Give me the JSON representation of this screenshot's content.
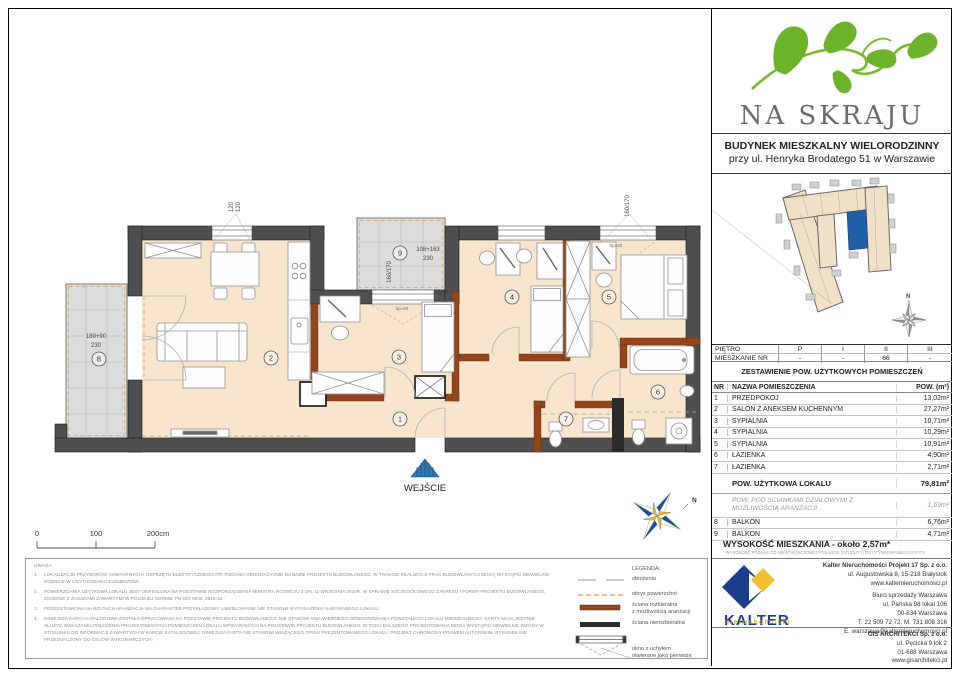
{
  "brand": {
    "title": "NA SKRAJU"
  },
  "building_info": {
    "line1": "BUDYNEK MIESZKALNY WIELORODZINNY",
    "line2": "przy ul. Henryka Brodatego 51 w Warszawie"
  },
  "floor_table": {
    "floor_label": "PIĘTRO",
    "floors": [
      "P",
      "I",
      "II",
      "III"
    ],
    "apt_label": "MIESZKANIE NR",
    "apt_values": [
      "-",
      "-",
      "66",
      "-"
    ]
  },
  "area_table": {
    "title": "ZESTAWIENIE POW. UŻYTKOWYCH POMIESZCZEŃ",
    "col_nr": "NR",
    "col_name": "NAZWA POMIESZCZENIA",
    "col_area": "POW. (m²)",
    "rows": [
      {
        "nr": "1",
        "name": "PRZEDPOKÓJ",
        "area": "13,02m²"
      },
      {
        "nr": "2",
        "name": "SALON Z ANEKSEM KUCHENNYM",
        "area": "27,27m²"
      },
      {
        "nr": "3",
        "name": "SYPIALNIA",
        "area": "10,71m²"
      },
      {
        "nr": "4",
        "name": "SYPIALNIA",
        "area": "10,29m²"
      },
      {
        "nr": "5",
        "name": "SYPIALNIA",
        "area": "10,91m²"
      },
      {
        "nr": "6",
        "name": "ŁAZIENKA",
        "area": "4,90m²"
      },
      {
        "nr": "7",
        "name": "ŁAZIENKA",
        "area": "2,71m²"
      }
    ],
    "total_label": "POW. UŻYTKOWA LOKALU",
    "total_area": "79,81m²",
    "partition_label": "POW. POD ŚCIANKAMI DZIAŁOWYMI Z MOŻLIWOŚCIĄ ARANŻACJI",
    "partition_area": "1,69m²",
    "extra_rows": [
      {
        "nr": "8",
        "name": "BALKON",
        "area": "6,76m²"
      },
      {
        "nr": "9",
        "name": "BALKON",
        "area": "4,71m²"
      }
    ]
  },
  "height_info": {
    "text": "WYSOKOŚĆ MIESZKANIA - około 2,57m*",
    "footnote": "* WYSOKOŚĆ PODANA OD NIEWYKOŃCZONEJ POSADZKI (SZLICHTY) DO OTYNKOWANEGO SUFITU"
  },
  "plan": {
    "entrance_label": "WEJŚCIE",
    "rooms": {
      "r1": "1",
      "r2": "2",
      "r3": "3",
      "r4": "4",
      "r5": "5",
      "r6": "6",
      "r7": "7",
      "r8": "8",
      "r9": "9"
    },
    "dims": {
      "win_left_a": "120",
      "win_left_b": "120",
      "balc8_a": "180+90",
      "balc8_b": "230",
      "balc9_a": "108+163",
      "balc9_b": "230",
      "balc9_rot": "160/170",
      "win_right_rot": "160/170",
      "hp1": "hp=60",
      "hp2": "hp=60"
    },
    "north": "N",
    "scale_bar": {
      "t0": "0",
      "t1": "100",
      "t2": "200cm"
    }
  },
  "legend": {
    "title": "LEGENDA:",
    "items": [
      {
        "l1": "obniżenia",
        "l2": ""
      },
      {
        "l1": "obrys powierzchni",
        "l2": ""
      },
      {
        "l1": "ściana rozbieralna",
        "l2": "z możliwością aranżacji"
      },
      {
        "l1": "ściana nierozbieralna",
        "l2": ""
      },
      {
        "l1": "okno z uchyłem",
        "l2": "otwierane jako pierwsze"
      }
    ]
  },
  "notes": {
    "title": "UWAGA:",
    "items": [
      {
        "n": "1.",
        "text": "LOKALIZACJE PRZYBORÓW SANITARNYCH I OSPRZĘTU ELEKTRYCZNEGO ITP. PODANO ORIENTACYJNIE NA BAZIE PROJEKTU BUDOWLANEGO. W TRAKCIE REALIZACJI PRAC BUDOWLANYCH MOGĄ WYSTĄPIĆ NIEWIELKIE RÓŻNICE W USYTUOWANIU ELEMENTÓW."
      },
      {
        "n": "2.",
        "text": "POWIERZCHNIA UŻYTKOWA LOKALU JEST OKREŚLONA NA PODSTAWIE ROZPORZĄDZENIA MINISTRA ROZWOJU Z DN. 11 WRZEŚNIA 2020R. W SPRAWIE SZCZEGÓŁOWEGO ZAKRESU I FORMY PROJEKTU BUDOWLANEGO, ZGODNIE Z ZASADAMI ZAWARTYMI W POLSKIEJ NORMIE PN-ISO 9836: 2015-12."
      },
      {
        "n": "3.",
        "text": "PRZEDSTAWIONA NA RZUTACH ARANŻACJA MA CHARAKTER PRZYKŁADOWY. UMEBLOWANIE NIE STANOWI WYPOSAŻENIA NABYWANEGO LOKALU."
      },
      {
        "n": "4.",
        "text": "NINIEJSZA KARTA KATALOGOWA ZOSTAŁA OPRACOWANA NA PODSTAWIE PROJEKTU BUDOWLANEGO. NIE STANOWI ONA WIERNEGO ODWZOROWANIA POWSTAŁEGO LOKALU MIESZKALNEGO. KARTY MAJĄ JEDYNIE SŁUŻYĆ WSKAZANIU POŁOŻENIA PROJEKTOWANYCH POMIESZCZEŃ LOKALU WPISYWANYCH NA PODSTAWIE PROJEKTU BUDOWLANEGO. W TOKU DALSZEGO PROJEKTOWANIA MOGĄ WYSTĄPIĆ NIEWIELKIE ZMIANY W STOSUNKU DO INFORMACJI ZAWARTYCH W KARCIE KATALOGOWEJ. NINIEJSZA KARTA NIE STANOWI WIĄŻĄCEGO OPISU PREZENTOWANEGO LOKALU. PROJEKT CHRONIONY PRAWEM AUTORSKIM. RYSUNEK NIE PRZEZNACZONY DO CELÓW WYKONAWCZYCH."
      }
    ]
  },
  "kalter": {
    "logo_text": "KALTER",
    "logo_sub": "nieruchomości",
    "company": "Kalter Nieruchomości Projekt 17 Sp. z o.o.",
    "addr1": "ul. Augustowska 8, 15-218 Białystok",
    "web": "www.kalternieruchomosci.pl",
    "office": "Biuro sprzedaży Warszawa",
    "office_addr1": "ul. Pańska 98 lokal 106",
    "office_addr2": "00-834 Warszawa",
    "phones": "T. 22 509 72 72. M. 731 808 316",
    "email": "E. warszawa@kalternieruchomosci.pl"
  },
  "gis": {
    "company": "GIS ARCHITEKCI Sp. z o.o.",
    "addr1": "ul. Pęcicka 9 lok 2",
    "addr2": "01-688 Warszawa",
    "web": "www.gisarchitekci.pl"
  },
  "colors": {
    "wall": "#4f4f4f",
    "floor": "#f8e5cc",
    "balcony": "#dcdcdc",
    "brown_wall": "#94451b",
    "accent_blue": "#2f76b5",
    "logo_green": "#6db32a",
    "kalter_blue": "#1c3c8c",
    "kalter_yellow": "#f0c02f",
    "unit_blue": "#1f5fa8"
  }
}
